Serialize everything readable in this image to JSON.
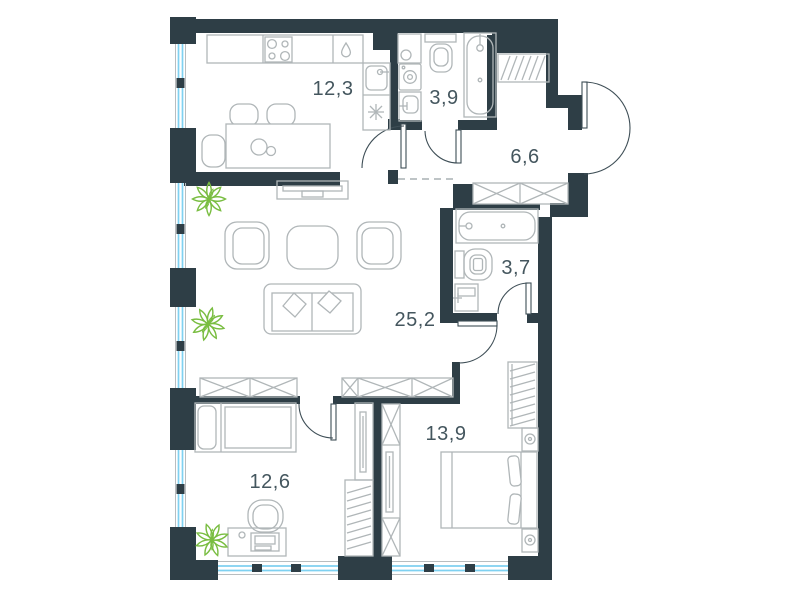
{
  "plan": {
    "type": "apartment-floor-plan",
    "rooms": [
      {
        "name": "kitchen-dining",
        "area": "12,3"
      },
      {
        "name": "bathroom-top",
        "area": "3,9"
      },
      {
        "name": "hallway",
        "area": "6,6"
      },
      {
        "name": "bathroom-right",
        "area": "3,7"
      },
      {
        "name": "living-room",
        "area": "25,2"
      },
      {
        "name": "bedroom-left",
        "area": "12,6"
      },
      {
        "name": "bedroom-right",
        "area": "13,9"
      }
    ],
    "colors": {
      "wall": "#2e3e46",
      "furniture_line": "#b0b6b8",
      "window_glass": "#7fd1f1",
      "door_line": "#3e4e56",
      "plant": "#79bd41",
      "label_text": "#44565e",
      "background": "#ffffff"
    },
    "fixtures": [
      "stove-icon",
      "kitchen-sink-icon",
      "water-drop-icon",
      "asterisk-icon",
      "dining-table",
      "dining-chair",
      "washing-machine-icon",
      "toilet-icon",
      "bathtub-icon",
      "coat-rail-icon",
      "closet-icon",
      "tv-stand",
      "armchair",
      "coffee-table",
      "sofa",
      "pillow",
      "wardrobe-icon",
      "hanger-wardrobe-icon",
      "single-bed",
      "double-bed",
      "nightstand-icon",
      "desk",
      "desk-chair",
      "tv-panel",
      "plant-icon",
      "entrance-door",
      "interior-door",
      "window"
    ]
  }
}
